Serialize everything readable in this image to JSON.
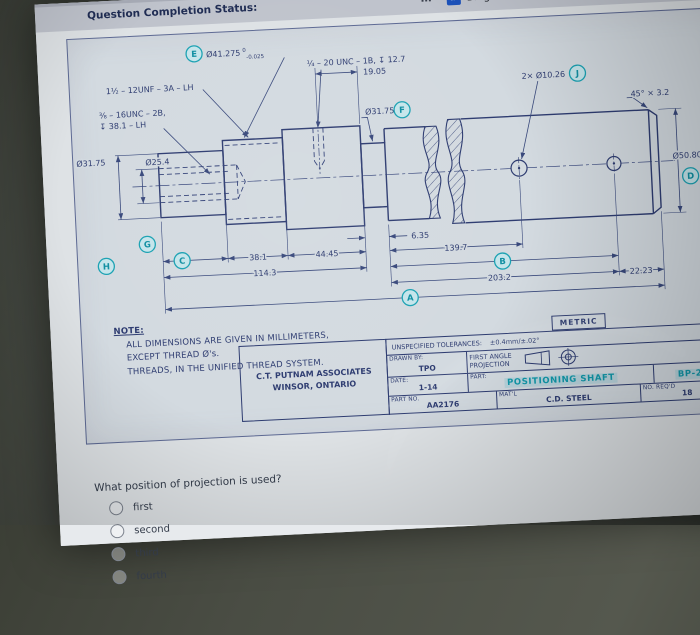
{
  "colors": {
    "ink": "#2e3c72",
    "accent": "#1ba7b8",
    "paper": "#dce2e7"
  },
  "browser": {
    "overflow": "…",
    "status": "Question Completion Status:",
    "bookmarks": [
      {
        "label": "Bing"
      },
      {
        "label": "Java Basic Operators"
      }
    ]
  },
  "drawing": {
    "balloons": {
      "a": "A",
      "b": "B",
      "c": "C",
      "d": "D",
      "e": "E",
      "f": "F",
      "g": "G",
      "h": "H",
      "j": "J"
    },
    "callouts": {
      "e_dia": "Ø41.275",
      "e_tol_top": "0",
      "e_tol_bot": "-0.025",
      "thread_unf": "1½ – 12UNF – 3A – LH",
      "thread_unc2b_1": "⅜ – 16UNC – 2B,",
      "thread_unc2b_2": "↧ 38.1 – LH",
      "thread_unc1b": "¼ – 20 UNC – 1B, ↧ 12.7",
      "dim_19_05": "19.05",
      "dia_f": "Ø31.75",
      "holes": "2× Ø10.26",
      "chamfer": "45° × 3.2",
      "dia_d": "Ø50.80",
      "d_tol_top": "0",
      "d_tol_bot": "-0.025",
      "dia_31_75": "Ø31.75",
      "dia_25_4": "Ø25.4"
    },
    "dims": {
      "d38_1": "38.1",
      "d44_45": "44.45",
      "d114_3": "114.3",
      "d6_35": "6.35",
      "d139_7": "139.7",
      "d203_2": "203.2",
      "d22_23": "22.23"
    },
    "note": {
      "heading": "NOTE:",
      "line1": "ALL DIMENSIONS ARE GIVEN IN MILLIMETERS,",
      "line2": "EXCEPT THREAD Ø's.",
      "line3": "THREADS, IN THE UNIFIED THREAD SYSTEM."
    },
    "title_block": {
      "metric": "METRIC",
      "tol_label": "UNSPECIFIED TOLERANCES:",
      "tol_value": "±0.4mm/±.02°",
      "company1": "C.T. PUTNAM ASSOCIATES",
      "company2": "WINSOR, ONTARIO",
      "drawn_by_label": "DRAWN BY:",
      "drawn_by": "TPO",
      "projection_label1": "FIRST ANGLE",
      "projection_label2": "PROJECTION",
      "date_label": "DATE:",
      "date": "1-14",
      "part_label": "PART:",
      "part": "POSITIONING SHAFT",
      "dwg_no": "BP-23",
      "part_no_label": "PART NO.",
      "part_no": "AA2176",
      "matl_label": "MAT'L",
      "matl": "C.D. STEEL",
      "reqd_label": "NO. REQ'D",
      "reqd": "18"
    }
  },
  "question": {
    "text": "What position of projection is used?",
    "options": [
      "first",
      "second",
      "third",
      "fourth"
    ]
  }
}
